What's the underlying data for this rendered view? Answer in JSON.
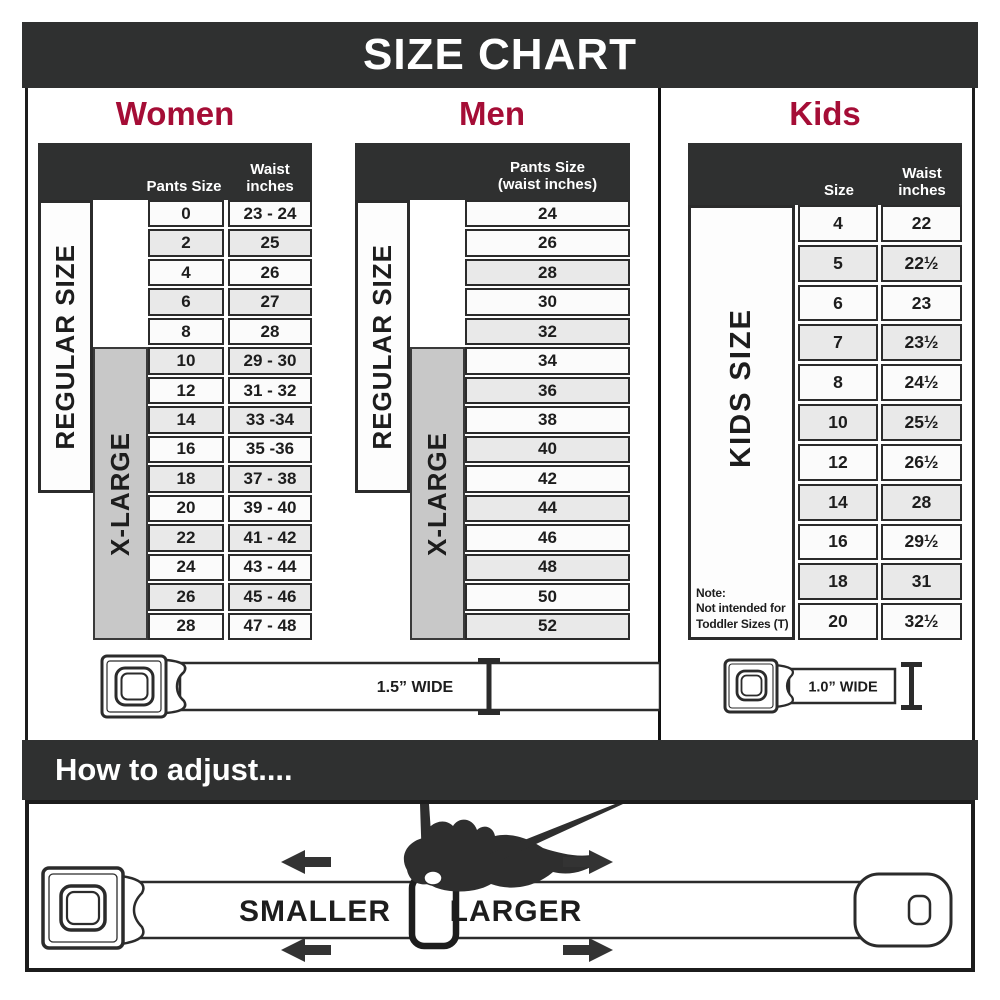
{
  "header": {
    "title": "SIZE CHART"
  },
  "colors": {
    "accent": "#a50d36",
    "dark_bar": "#2f3030",
    "row_alt": "#e9e9e9",
    "xlarge_gray": "#c8c8c8"
  },
  "women": {
    "heading": "Women",
    "col1_header": "Pants Size",
    "col2_header_line1": "Waist",
    "col2_header_line2": "inches",
    "regular_label": "REGULAR SIZE",
    "xlarge_label": "X-LARGE",
    "rows": [
      {
        "size": "0",
        "waist": "23 - 24"
      },
      {
        "size": "2",
        "waist": "25"
      },
      {
        "size": "4",
        "waist": "26"
      },
      {
        "size": "6",
        "waist": "27"
      },
      {
        "size": "8",
        "waist": "28"
      },
      {
        "size": "10",
        "waist": "29 - 30"
      },
      {
        "size": "12",
        "waist": "31 - 32"
      },
      {
        "size": "14",
        "waist": "33 -34"
      },
      {
        "size": "16",
        "waist": "35 -36"
      },
      {
        "size": "18",
        "waist": "37 - 38"
      },
      {
        "size": "20",
        "waist": "39 - 40"
      },
      {
        "size": "22",
        "waist": "41 - 42"
      },
      {
        "size": "24",
        "waist": "43 - 44"
      },
      {
        "size": "26",
        "waist": "45 - 46"
      },
      {
        "size": "28",
        "waist": "47 - 48"
      }
    ]
  },
  "men": {
    "heading": "Men",
    "col_header_line1": "Pants Size",
    "col_header_line2": "(waist inches)",
    "regular_label": "REGULAR SIZE",
    "xlarge_label": "X-LARGE",
    "rows": [
      "24",
      "26",
      "28",
      "30",
      "32",
      "34",
      "36",
      "38",
      "40",
      "42",
      "44",
      "46",
      "48",
      "50",
      "52"
    ]
  },
  "kids": {
    "heading": "Kids",
    "col1_header": "Size",
    "col2_header_line1": "Waist",
    "col2_header_line2": "inches",
    "label": "KIDS SIZE",
    "note_line1": "Note:",
    "note_line2": "Not intended for",
    "note_line3": "Toddler Sizes (T)",
    "rows": [
      {
        "size": "4",
        "waist": "22"
      },
      {
        "size": "5",
        "waist": "22½"
      },
      {
        "size": "6",
        "waist": "23"
      },
      {
        "size": "7",
        "waist": "23½"
      },
      {
        "size": "8",
        "waist": "24½"
      },
      {
        "size": "10",
        "waist": "25½"
      },
      {
        "size": "12",
        "waist": "26½"
      },
      {
        "size": "14",
        "waist": "28"
      },
      {
        "size": "16",
        "waist": "29½"
      },
      {
        "size": "18",
        "waist": "31"
      },
      {
        "size": "20",
        "waist": "32½"
      }
    ]
  },
  "belts": {
    "adult_width_label": "1.5” WIDE",
    "kids_width_label": "1.0” WIDE"
  },
  "adjust": {
    "heading": "How to adjust....",
    "smaller_label": "SMALLER",
    "larger_label": "LARGER"
  }
}
